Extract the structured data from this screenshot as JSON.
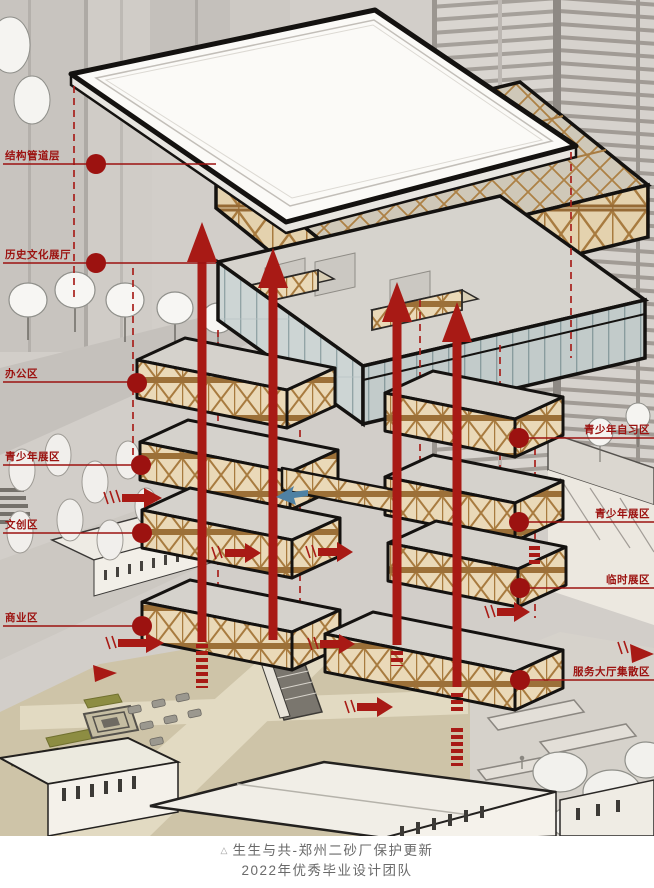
{
  "colors": {
    "callout_red": "#9c1210",
    "arrow_red": "#a81a15",
    "wood": "#a87b3f",
    "wood_bg": "#ead9b8",
    "glass": "#cdd5d4",
    "plaza_beige": "#cec4a8",
    "background_gray": "#d2cec9",
    "flow_blue": "#4f81a3"
  },
  "labels": {
    "left": [
      {
        "text": "结构管道层"
      },
      {
        "text": "历史文化展厅"
      },
      {
        "text": "办公区"
      },
      {
        "text": "青少年展区"
      },
      {
        "text": "文创区"
      },
      {
        "text": "商业区"
      }
    ],
    "right": [
      {
        "text": "青少年自习区"
      },
      {
        "text": "青少年展区"
      },
      {
        "text": "临时展区"
      },
      {
        "text": "服务大厅集散区"
      }
    ]
  },
  "caption": {
    "marker": "△",
    "line1": "生生与共-郑州二砂厂保护更新",
    "line2": "2022年优秀毕业设计团队"
  }
}
